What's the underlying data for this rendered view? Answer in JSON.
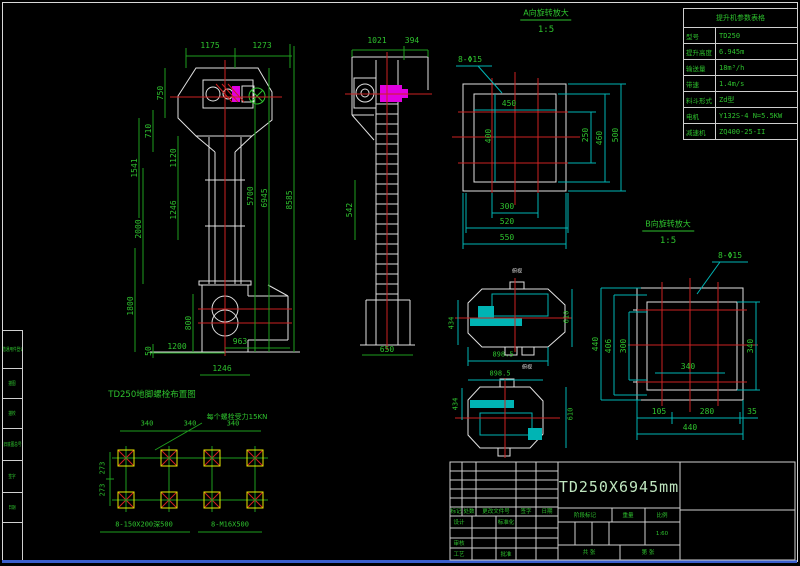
{
  "colors": {
    "background": "#000000",
    "object_line": "#e0e0e0",
    "dimension_text": "#2ec22e",
    "dimension_line_cyan": "#00b4b4",
    "centerline_red": "#cc2222",
    "motor_magenta": "#e000e0",
    "bolt_yellow": "#e8e800",
    "frame_accent_blue": "#3a5fcd",
    "title_text": "#bfe6bf"
  },
  "side_strip": {
    "items": [
      "借通用件登记",
      "描图",
      "描校",
      "旧底图总号",
      "签字",
      "日期"
    ]
  },
  "param_table": {
    "title": "提升机参数表格",
    "rows": [
      {
        "label": "型号",
        "value": "TD250"
      },
      {
        "label": "提升高度",
        "value": "6.945m"
      },
      {
        "label": "输送量",
        "value": "18m³/h"
      },
      {
        "label": "带速",
        "value": "1.4m/s"
      },
      {
        "label": "料斗形式",
        "value": "Zd型"
      },
      {
        "label": "电机",
        "value": "Y132S-4 N=5.5KW"
      },
      {
        "label": "减速机",
        "value": "ZQ400-25-II"
      }
    ]
  },
  "view_labels": {
    "a": "A向旋转放大",
    "a_scale": "1:5",
    "b": "B向旋转放大",
    "b_scale": "1:5",
    "top1": "俯视",
    "top2": "俯视"
  },
  "dims": {
    "main": {
      "top": [
        "1175",
        "1273"
      ],
      "left": [
        "750",
        "710",
        "1541",
        "1120",
        "1246",
        "2000",
        "1800",
        "800",
        "50"
      ],
      "right": [
        "5700",
        "6945",
        "8585"
      ],
      "bottom": [
        "1200",
        "963",
        "1246"
      ]
    },
    "side": {
      "top": [
        "1021",
        "394"
      ],
      "left": "542",
      "bottom": "650"
    },
    "view_a": {
      "holes": "8-Φ15",
      "top": "450",
      "left": "400",
      "right": [
        "250",
        "460",
        "500"
      ],
      "bottom": [
        "300",
        "520",
        "550"
      ]
    },
    "view_b": {
      "holes": "8-Φ15",
      "left": [
        "440",
        "406",
        "300"
      ],
      "right": "340",
      "inner_bottom": "340",
      "bottom": [
        "105",
        "280",
        "35"
      ],
      "total": "440"
    },
    "top1": {
      "left": "434",
      "right": "610",
      "bottom": "898.5"
    },
    "top2": {
      "top": "898.5",
      "left": "434",
      "right": "610"
    }
  },
  "bolt_layout": {
    "title": "TD250地脚螺栓布置图",
    "note": "每个螺栓受力15KN",
    "top_dims": [
      "340",
      "340",
      "340"
    ],
    "left_dims": [
      "273",
      "273"
    ],
    "pocket_label": "8-150X200深500",
    "bolt_label": "8-M16X500"
  },
  "title_block": {
    "drawing_title": "TD250X6945mm",
    "rev_headers": [
      "标记",
      "处数",
      "更改文件号",
      "签字",
      "日期"
    ],
    "design": "设计",
    "standardization": "标准化",
    "audit": "审核",
    "process": "工艺",
    "approve": "批准",
    "stage": "阶段标记",
    "weight": "重量",
    "scale": "比例",
    "scale_value": "1:60",
    "sheet_total": "共 张",
    "sheet_index": "第 张"
  }
}
